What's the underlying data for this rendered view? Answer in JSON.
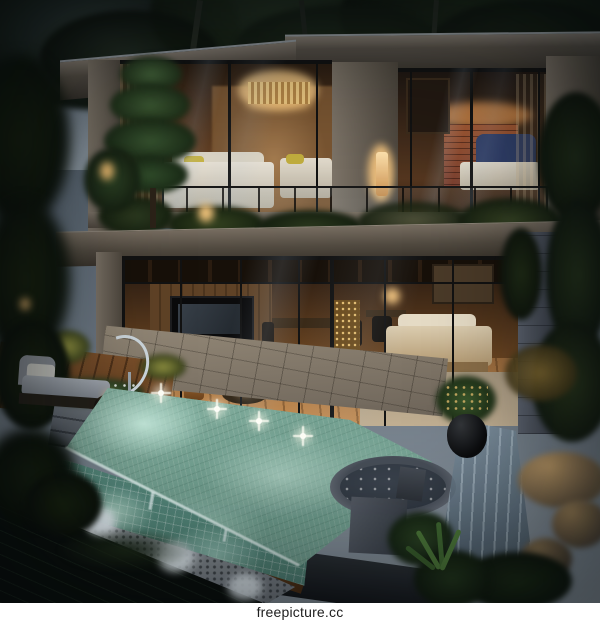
{
  "caption": {
    "text": "freepicture.cc"
  },
  "palette": {
    "sky_top": "#46525f",
    "sky_bottom": "#8c97a1",
    "foliage_dark": "#101810",
    "foliage_mid": "#1d2919",
    "concrete_light": "#7d7468",
    "concrete_dark": "#4e473e",
    "frame_black": "#121212",
    "interior_warm": "#8a5a2e",
    "interior_glow": "#e8b878",
    "lamp_glow": "#ffd9a3",
    "wood_wall": "#5f4226",
    "wood_floor": "#9a6b3d",
    "brick": "#7a4030",
    "bed_white": "#e8e2d6",
    "bed_blue": "#31406b",
    "bed_cream": "#dccdb0",
    "deck_wood": "#7a4f2a",
    "stone_grey": "#6d737c",
    "stone_light": "#989da6",
    "pool_teal": "#7ba899",
    "pool_glow": "#c2e7d9",
    "tile_teal": "#55897c",
    "pond_dark": "#0a0f0c",
    "jacuzzi_water": "#323a44",
    "plant_green": "#2c4527",
    "caption_bg": "#ffffff",
    "caption_text": "#1e1e1e"
  }
}
